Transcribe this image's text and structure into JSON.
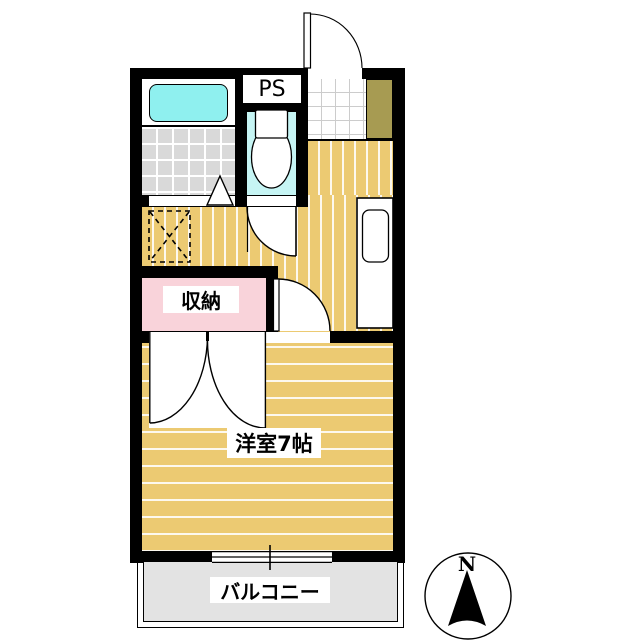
{
  "plan": {
    "labels": {
      "ps": "PS",
      "storage": "収納",
      "main_room": "洋室7帖",
      "balcony": "バルコニー"
    },
    "rooms_visible": [
      "unit-bath",
      "toilet",
      "entry",
      "hallway",
      "storage-closet",
      "western-room-7jo",
      "balcony"
    ]
  },
  "compass": {
    "north": "N"
  },
  "colors": {
    "wall_black": "#000000",
    "floor_tan": "#ecca72",
    "floor_stripe_white": "#f6efd9",
    "bathtub_cyan": "#8ff0ef",
    "toilet_floor_cyan": "#c6f5f4",
    "bath_tile_gray": "#d9d9d9",
    "storage_pink": "#f9d3da",
    "shoe_cabinet_khaki": "#a79b52",
    "balcony_gray": "#e3e3e3",
    "background_white": "#ffffff"
  }
}
